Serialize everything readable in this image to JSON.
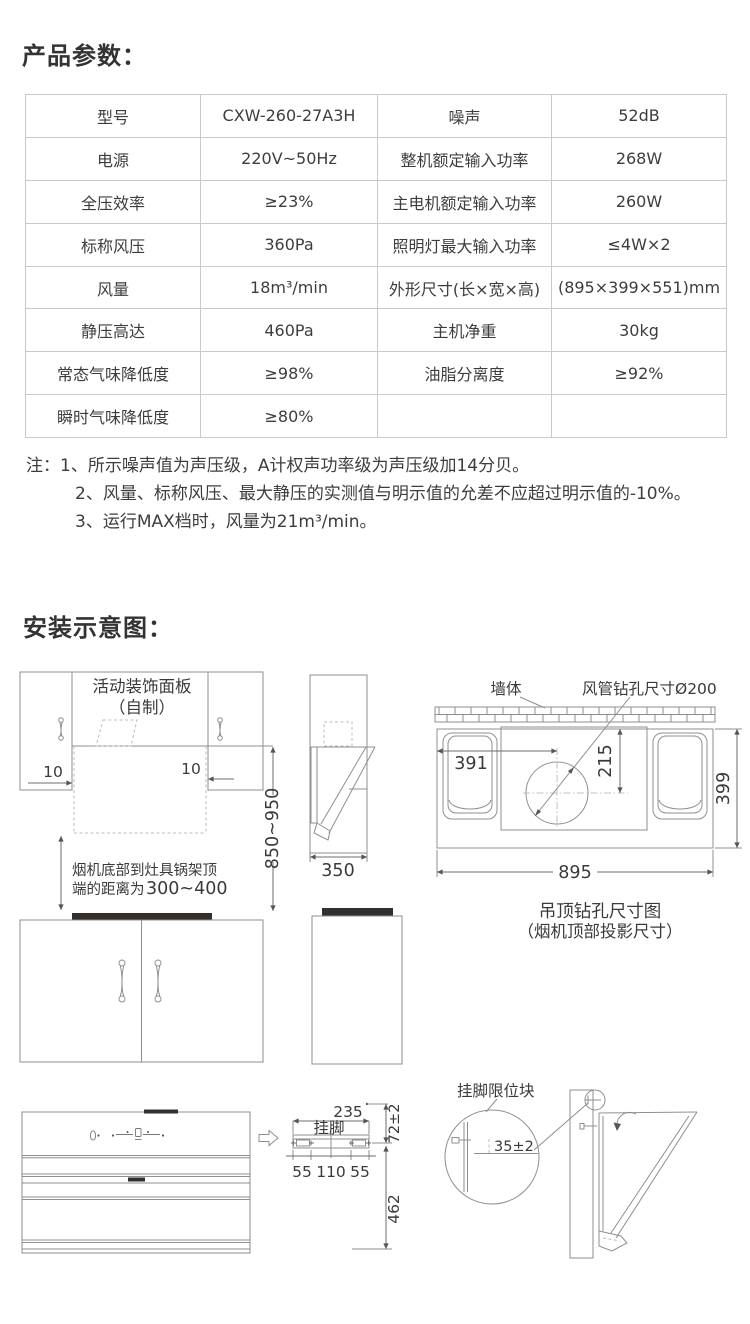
{
  "params_section": {
    "title": "产品参数：",
    "table": {
      "rows": [
        {
          "c1": "型号",
          "c2": "CXW-260-27A3H",
          "c3": "噪声",
          "c4": "52dB"
        },
        {
          "c1": "电源",
          "c2": "220V~50Hz",
          "c3": "整机额定输入功率",
          "c4": "268W"
        },
        {
          "c1": "全压效率",
          "c2": "≥23%",
          "c3": "主电机额定输入功率",
          "c4": "260W"
        },
        {
          "c1": "标称风压",
          "c2": "360Pa",
          "c3": "照明灯最大输入功率",
          "c4": "≤4W×2"
        },
        {
          "c1": "风量",
          "c2": "18m³/min",
          "c3": "外形尺寸(长×宽×高)",
          "c4": "(895×399×551)mm"
        },
        {
          "c1": "静压高达",
          "c2": "460Pa",
          "c3": "主机净重",
          "c4": "30kg"
        },
        {
          "c1": "常态气味降低度",
          "c2": "≥98%",
          "c3": "油脂分离度",
          "c4": "≥92%"
        },
        {
          "c1": "瞬时气味降低度",
          "c2": "≥80%",
          "c3": "",
          "c4": ""
        }
      ]
    },
    "notes": {
      "line1": "注：1、所示噪声值为声压级，A计权声功率级为声压级加14分贝。",
      "line2": "2、风量、标称风压、最大静压的实测值与明示值的允差不应超过明示值的-10%。",
      "line3": "3、运行MAX档时，风量为21m³/min。"
    }
  },
  "install_section": {
    "title": "安装示意图：",
    "front_view": {
      "panel_label_line1": "活动装饰面板",
      "panel_label_line2": "（自制）",
      "gap_left": "10",
      "gap_right": "10",
      "height_range": "850~950",
      "distance_note_line1": "烟机底部到灶具锅架顶",
      "distance_note_line2": "端的距离为",
      "distance_value": "300~400"
    },
    "side_view": {
      "depth": "350"
    },
    "top_view": {
      "wall_label": "墙体",
      "duct_hole_label": "风管钻孔尺寸Ø200",
      "dim_left_to_center": "391",
      "dim_top_to_center": "215",
      "dim_depth": "399",
      "dim_width": "895",
      "caption_line1": "吊顶钻孔尺寸图",
      "caption_line2": "（烟机顶部投影尺寸）"
    },
    "bracket_detail": {
      "label": "挂脚",
      "dim_width": "235",
      "dim_top": "72±2",
      "dim_left": "55",
      "dim_mid": "110",
      "dim_right": "55",
      "dim_height": "462"
    },
    "limit_block_detail": {
      "label": "挂脚限位块",
      "dim_offset": "35±2"
    }
  }
}
